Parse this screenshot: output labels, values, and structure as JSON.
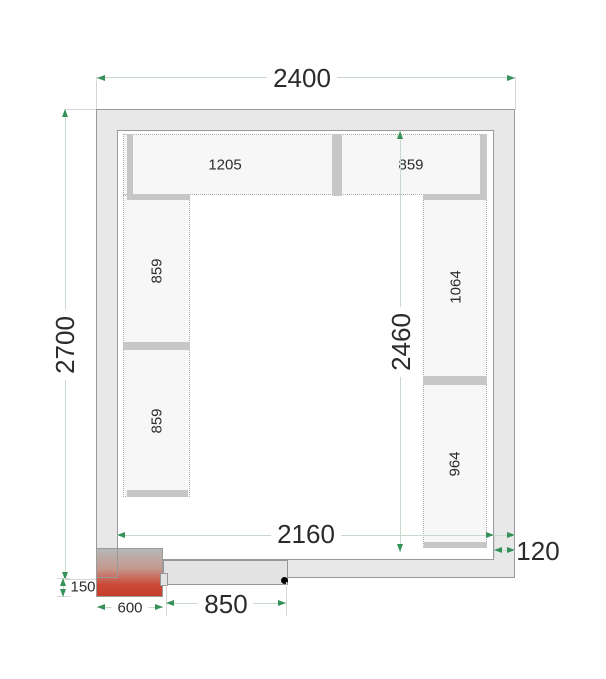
{
  "drawing_title": "Cold room floor plan",
  "dimensions": {
    "outer_width": "2400",
    "outer_height": "2700",
    "inner_width": "2160",
    "inner_height": "2460",
    "wall_thickness": "120",
    "door_width": "850",
    "unit_width": "600",
    "unit_offset": "150"
  },
  "shelves": {
    "top_left": "1205",
    "top_right": "859",
    "left_upper": "859",
    "left_lower": "859",
    "right_upper": "1064",
    "right_lower": "964"
  },
  "colors": {
    "accent_green": "#35915a",
    "dim_line": "#c9d9cc",
    "wall_fill": "#e8e8e8",
    "wall_border": "#9a9a9a",
    "shelf_fill": "#f7f7f7",
    "bar_fill": "#c7c7c7",
    "unit_red": "#c84a36",
    "text_color": "#2b2b2b"
  }
}
